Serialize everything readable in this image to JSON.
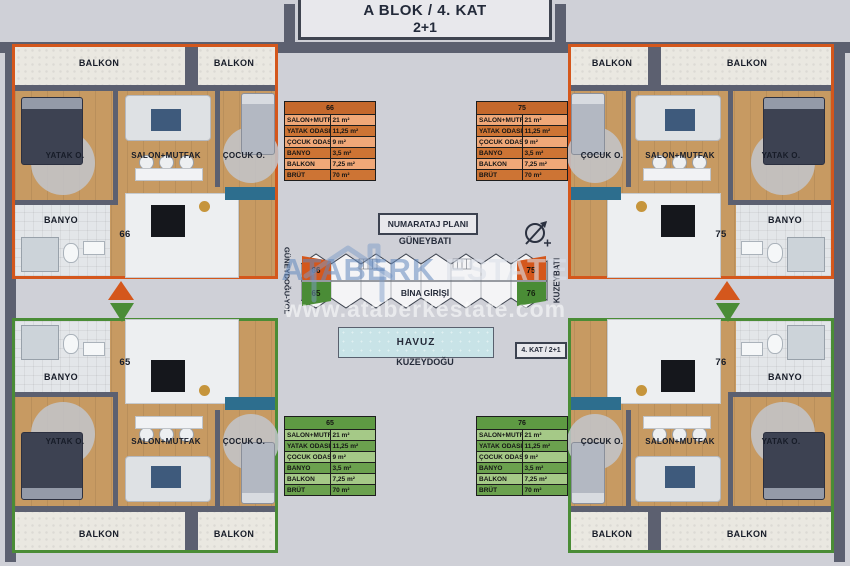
{
  "title": {
    "line1": "A BLOK / 4. KAT",
    "line2": "2+1"
  },
  "labels": {
    "balkon": "BALKON",
    "yatak": "YATAK O.",
    "salon": "SALON+MUTFAK",
    "cocuk": "ÇOCUK O.",
    "banyo": "BANYO"
  },
  "area_rows": [
    {
      "label": "SALON+MUTFAK",
      "value": "21 m²"
    },
    {
      "label": "YATAK ODASI",
      "value": "11,25 m²"
    },
    {
      "label": "ÇOCUK ODASI",
      "value": "9 m²"
    },
    {
      "label": "BANYO",
      "value": "3,5 m²"
    },
    {
      "label": "BALKON",
      "value": "7,25 m²"
    },
    {
      "label": "BRÜT",
      "value": "70 m²"
    }
  ],
  "units": [
    {
      "number": "66",
      "theme": "orange",
      "position": "top-left"
    },
    {
      "number": "75",
      "theme": "orange",
      "position": "top-right"
    },
    {
      "number": "65",
      "theme": "green",
      "position": "bottom-left"
    },
    {
      "number": "76",
      "theme": "green",
      "position": "bottom-right"
    }
  ],
  "center": {
    "plan_title": "NUMARATAJ PLANI",
    "direction_top": "GÜNEYBATI",
    "direction_bottom": "KUZEYDOĞU",
    "direction_left": "GÜNEYDOĞU-YOL",
    "direction_right": "KUZEYBATI",
    "entrance": "BİNA GİRİŞİ",
    "pool": "HAVUZ",
    "floor_badge": "4. KAT / 2+1",
    "mini_units": {
      "top_left": "66",
      "top_right": "75",
      "bottom_left": "65",
      "bottom_right": "76"
    }
  },
  "watermark": {
    "brand_first": "ATABERK",
    "brand_second": "ESTATE",
    "url": "www.ataberkestate.com"
  },
  "colors": {
    "orange": "#d4571c",
    "green": "#4a8c36",
    "wall": "#5c6070",
    "pool": "#c8e3e7"
  }
}
